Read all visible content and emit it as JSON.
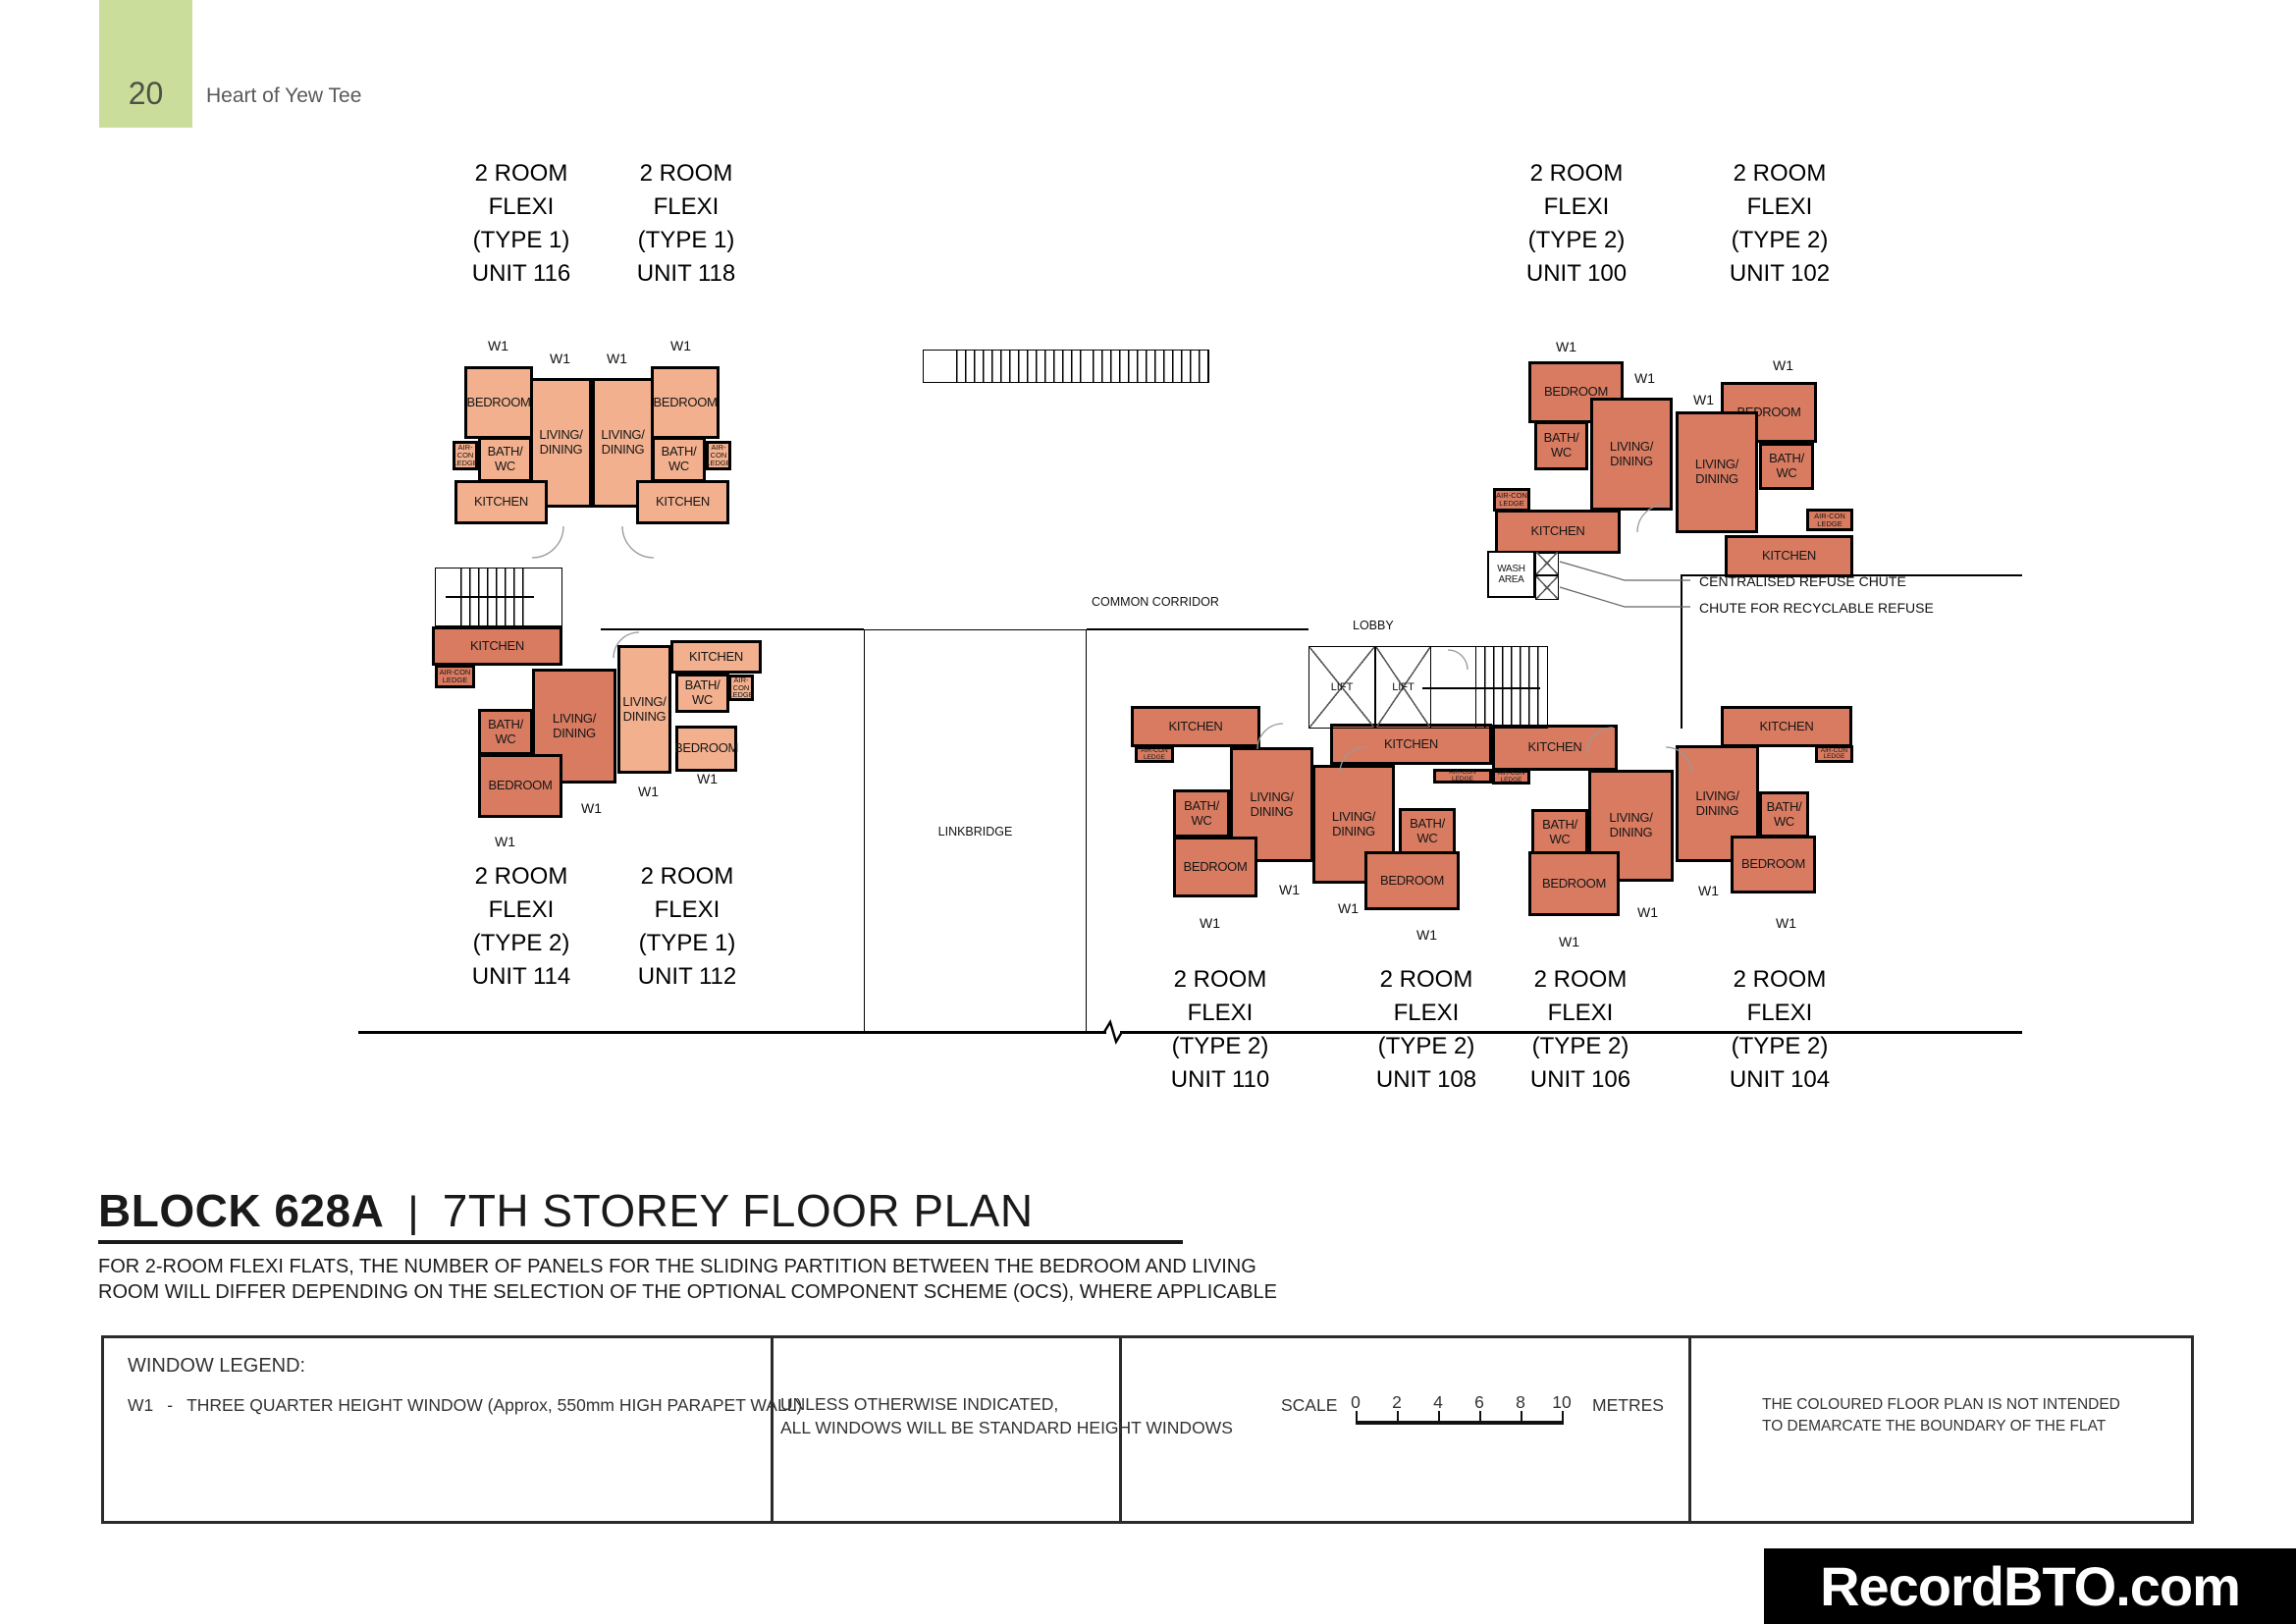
{
  "page": {
    "number": "20",
    "title": "Heart of Yew Tee"
  },
  "plan": {
    "rooms": {
      "bedroom": "BEDROOM",
      "living": "LIVING/\nDINING",
      "bath": "BATH/\nWC",
      "kitchen": "KITCHEN",
      "aircon": "AIR-CON\nLEDGE",
      "wash": "WASH\nAREA",
      "lift": "LIFT",
      "w1": "W1"
    },
    "areas": {
      "common_corridor": "COMMON CORRIDOR",
      "lobby": "LOBBY",
      "linkbridge": "LINKBRIDGE"
    },
    "annotations": {
      "refuse_chute": "CENTRALISED REFUSE CHUTE",
      "recyclable_chute": "CHUTE FOR RECYCLABLE REFUSE"
    },
    "units": {
      "u116": "2 ROOM\nFLEXI\n(TYPE 1)\nUNIT 116",
      "u118": "2 ROOM\nFLEXI\n(TYPE 1)\nUNIT 118",
      "u100": "2 ROOM\nFLEXI\n(TYPE 2)\nUNIT 100",
      "u102": "2 ROOM\nFLEXI\n(TYPE 2)\nUNIT 102",
      "u114": "2 ROOM\nFLEXI\n(TYPE 2)\nUNIT 114",
      "u112": "2 ROOM\nFLEXI\n(TYPE 1)\nUNIT 112",
      "u110": "2 ROOM\nFLEXI\n(TYPE 2)\nUNIT 110",
      "u108": "2 ROOM\nFLEXI\n(TYPE 2)\nUNIT 108",
      "u106": "2 ROOM\nFLEXI\n(TYPE 2)\nUNIT 106",
      "u104": "2 ROOM\nFLEXI\n(TYPE 2)\nUNIT 104"
    },
    "colors": {
      "type1": "#f2b08e",
      "type2": "#d87b61",
      "wall": "#000000"
    }
  },
  "title": {
    "block": "BLOCK 628A",
    "separator": "|",
    "name": "7TH STOREY FLOOR PLAN",
    "note": "FOR 2-ROOM FLEXI FLATS, THE NUMBER OF PANELS FOR THE SLIDING PARTITION BETWEEN THE BEDROOM AND LIVING\nROOM WILL DIFFER DEPENDING ON THE SELECTION OF THE OPTIONAL COMPONENT SCHEME (OCS), WHERE APPLICABLE"
  },
  "legend": {
    "window_legend_title": "WINDOW LEGEND:",
    "w1_code": "W1",
    "w1_dash": "-",
    "w1_desc": "THREE QUARTER HEIGHT WINDOW (Approx, 550mm HIGH PARAPET WALL)",
    "windows_note": "UNLESS OTHERWISE INDICATED,\nALL WINDOWS WILL BE STANDARD HEIGHT WINDOWS",
    "scale_label": "SCALE",
    "scale_ticks": [
      "0",
      "2",
      "4",
      "6",
      "8",
      "10"
    ],
    "scale_unit": "METRES",
    "boundary_note": "THE COLOURED FLOOR PLAN IS NOT INTENDED\nTO DEMARCATE THE BOUNDARY OF THE FLAT"
  },
  "footer": {
    "watermark": "RecordBTO.com"
  }
}
